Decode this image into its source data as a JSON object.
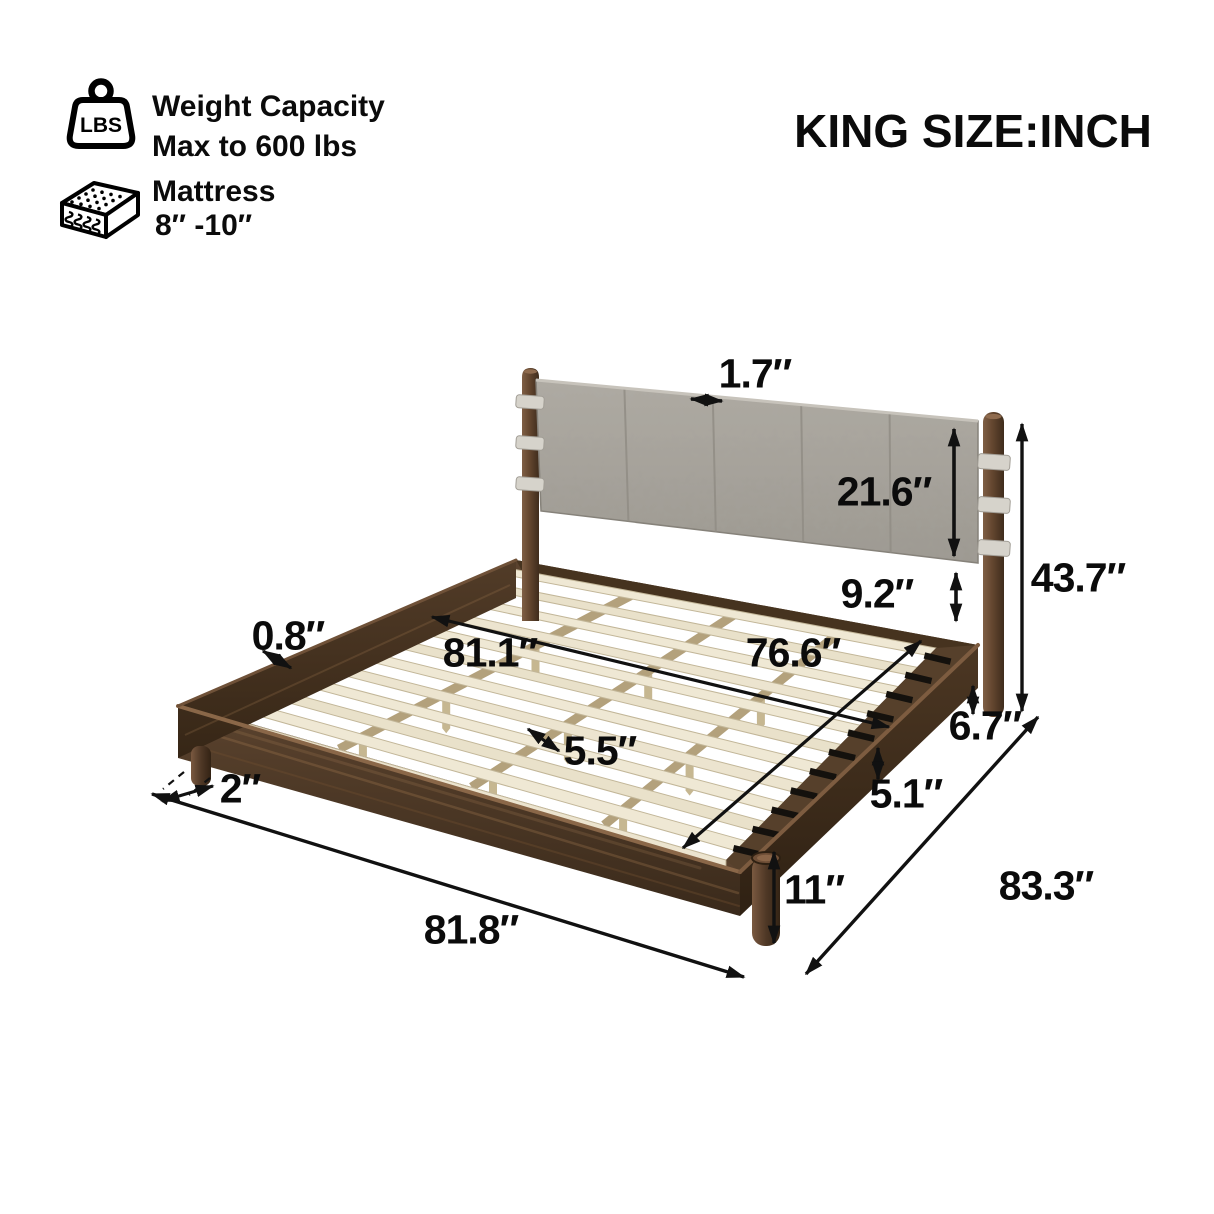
{
  "header": {
    "size_title": "KING SIZE:INCH",
    "weight": {
      "icon": "weight-lbs-icon",
      "icon_label": "LBS",
      "title": "Weight Capacity",
      "subtitle": "Max to 600 lbs"
    },
    "mattress": {
      "icon": "mattress-icon",
      "title": "Mattress",
      "subtitle": "8″ -10″"
    }
  },
  "dimensions": {
    "headboard_thickness": "1.7″",
    "headboard_height": "21.6″",
    "headboard_gap": "9.2″",
    "overall_height": "43.7″",
    "slat_overhang": "0.8″",
    "inner_length": "81.1″",
    "inner_width": "76.6″",
    "slat_spacing": "5.5″",
    "rail_thickness": "5.1″",
    "post_ground_clearance": "6.7″",
    "leg_height": "11″",
    "leg_inset": "2″",
    "overall_width": "81.8″",
    "overall_length": "83.3″"
  },
  "colors": {
    "wood_dark": "#42301f",
    "wood_mid": "#5b432e",
    "wood_light_rim": "#8a6748",
    "slat": "#ece4cf",
    "support_beam": "#b3a17c",
    "headboard_gray": "#a9a59e",
    "strap": "#d6d3cb",
    "bracket_teal": "#47707d",
    "arrow": "#111111"
  }
}
